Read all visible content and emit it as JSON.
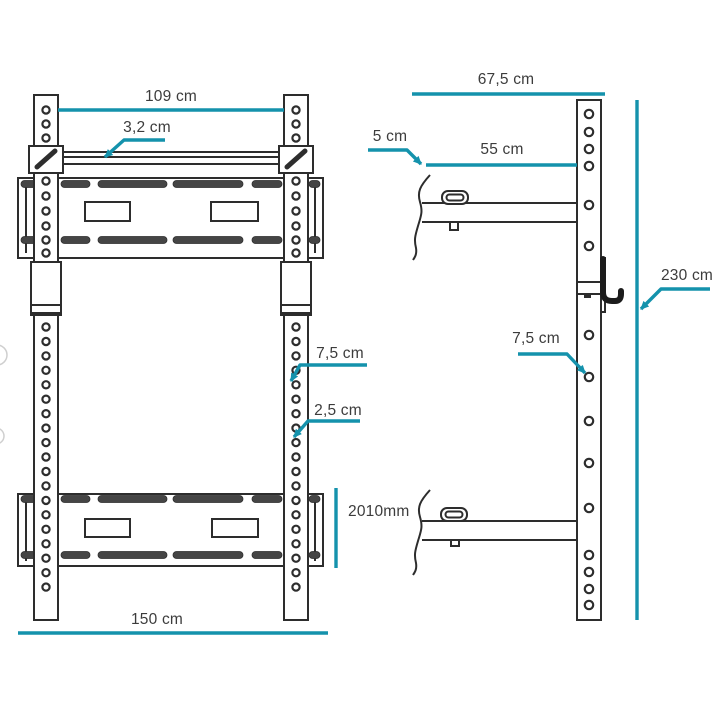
{
  "colors": {
    "dimension_accent": "#1492ac",
    "drawing_line": "#2d2d2d",
    "label_text": "#3c3c3c",
    "background": "#ffffff"
  },
  "dimensions": {
    "front_top_width": "109 cm",
    "front_bar_thickness": "3,2 cm",
    "front_hole_spacing": "7,5 cm",
    "front_hole_diameter": "2,5 cm",
    "front_panel_height": "2010mm",
    "front_base_width": "150 cm",
    "side_top_depth": "67,5 cm",
    "side_wall_gap": "5 cm",
    "side_arm_length": "55 cm",
    "side_total_height": "230 cm",
    "side_hole_spacing": "7,5 cm"
  }
}
